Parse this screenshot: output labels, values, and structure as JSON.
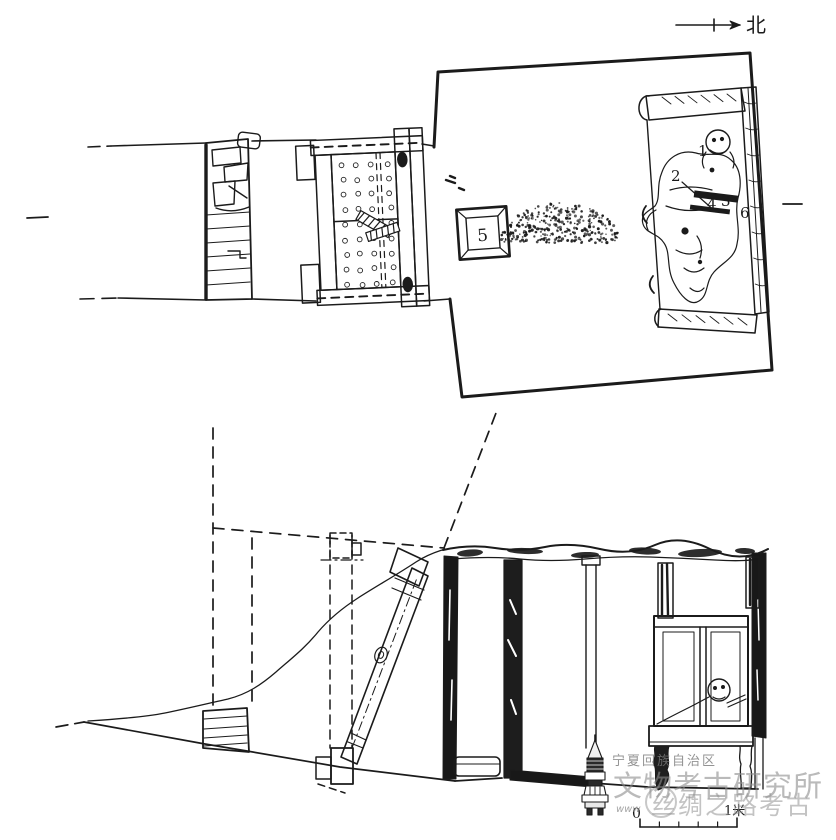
{
  "figure": {
    "north_label": "北",
    "plan": {
      "find_labels": {
        "1": "1",
        "2": "2",
        "3": "3",
        "4": "4",
        "5": "5",
        "6": "6"
      }
    },
    "section": {
      "scale": {
        "zero": "0",
        "one_meter": "1米"
      }
    },
    "watermark": {
      "region_line": "宁夏回族自治区",
      "institute_line": "文物考古研究所",
      "brand_line": "丝绸之路考古",
      "url_fragment": "www"
    }
  }
}
